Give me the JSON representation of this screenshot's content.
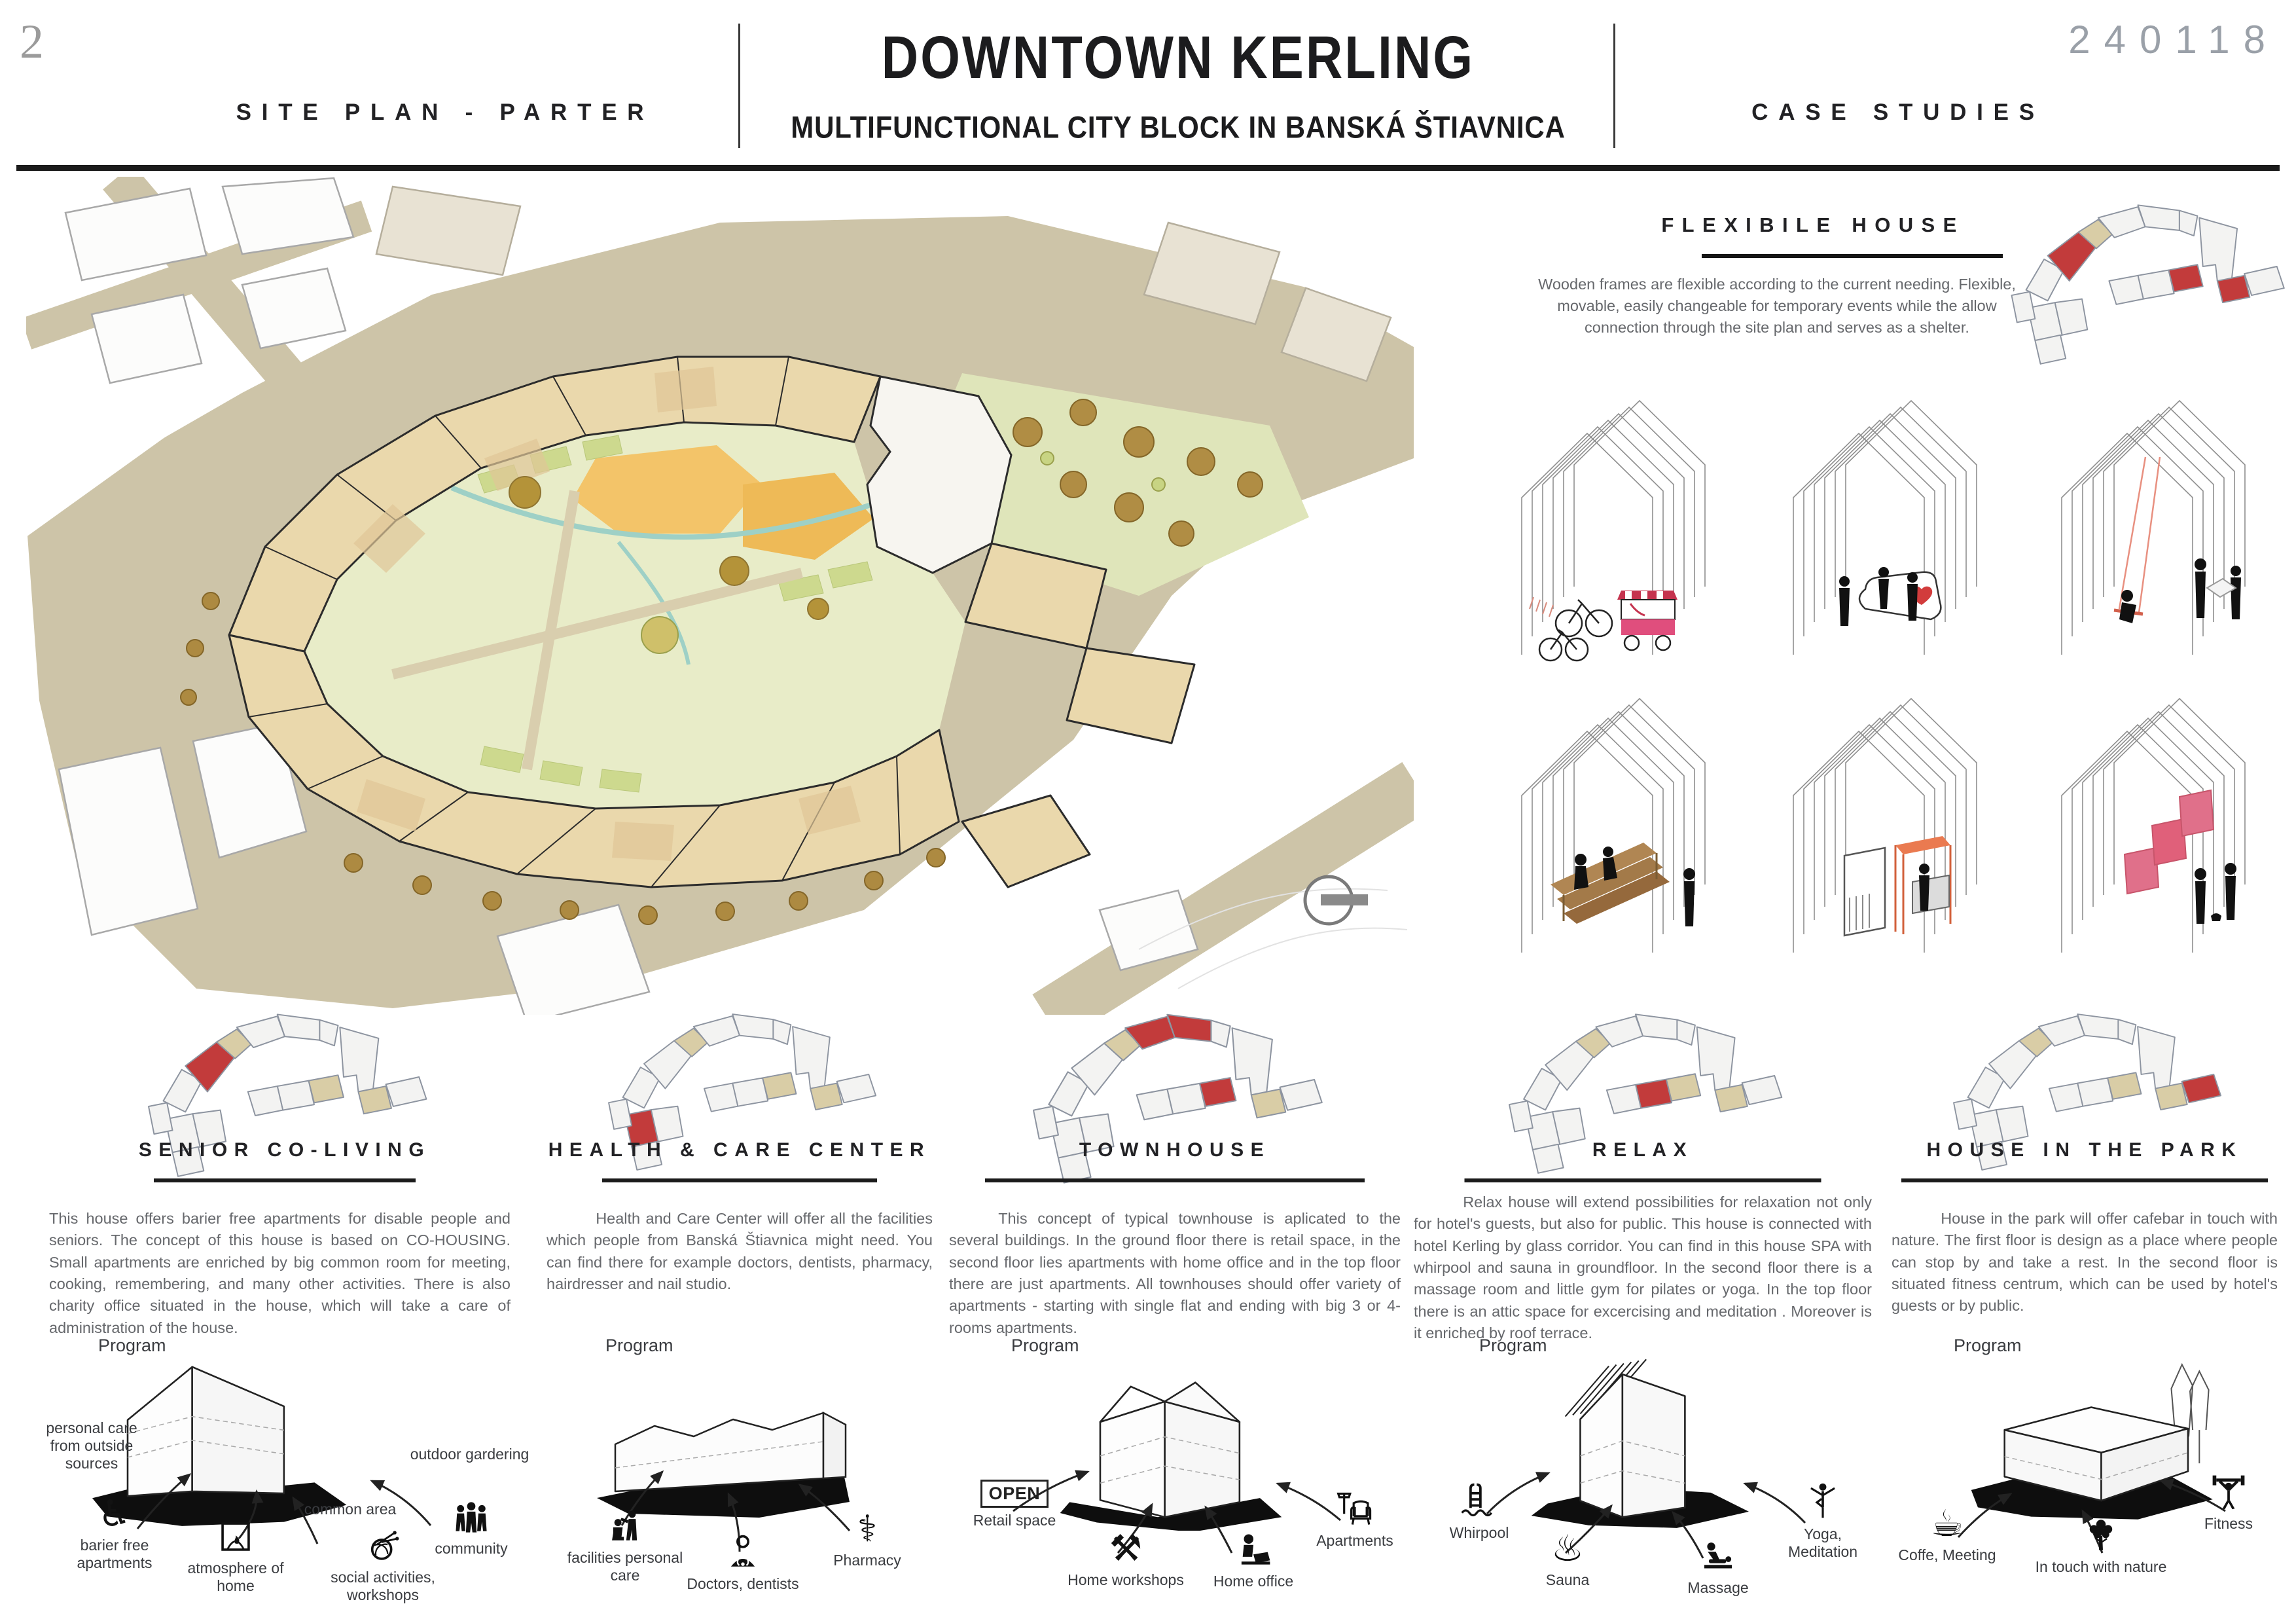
{
  "page": {
    "number": "2",
    "code": "240118"
  },
  "header": {
    "left_title": "SITE PLAN - PARTER",
    "title": "DOWNTOWN KERLING",
    "subtitle": "MULTIFUNCTIONAL CITY BLOCK IN BANSKÁ ŠTIAVNICA",
    "right_title": "CASE STUDIES"
  },
  "flexible_house": {
    "title": "FLEXIBILE HOUSE",
    "text": "Wooden frames are flexible according to the current needing. Flexible, movable, easily changeable for temporary events while the allow connection through the site plan and serves as a shelter.",
    "sketch_names": [
      "bike-parking and street-food cart",
      "info point",
      "swing",
      "wooden tribune",
      "café pavilion",
      "exhibition panels"
    ]
  },
  "labels": {
    "program": "Program"
  },
  "icons": {
    "wheelchair": "♿",
    "pharmacy": "⚕",
    "tools": "⚒",
    "sauna": "♨",
    "coffee": "☕",
    "open_sign": "OPEN"
  },
  "accent": {
    "red": "#c23b3b",
    "tan": "#d9cda6",
    "plan_beige": "#ead8ac",
    "court_green": "#e8ecc8"
  },
  "case_studies": [
    {
      "title": "SENIOR CO-LIVING",
      "text": "This house offers barier free apartments for disable people and seniors. The concept of this house is based on CO-HOUSING. Small apartments are enriched by big common room for meeting, cooking, remembering, and many other activities. There is also charity office situated in the house, which will take a care of administration of the house.",
      "items": [
        {
          "icon": "none",
          "label": "personal care from outside sources"
        },
        {
          "icon": "wheelchair",
          "label": "barier free apartments"
        },
        {
          "icon": "fireplace",
          "label": "atmosphere of home"
        },
        {
          "icon": "none",
          "label": "common area"
        },
        {
          "icon": "yarn",
          "label": "social activities, workshops"
        },
        {
          "icon": "community",
          "label": "community"
        },
        {
          "icon": "none",
          "label": "outdoor gardering"
        }
      ]
    },
    {
      "title": "HEALTH & CARE CENTER",
      "text": "Health and Care Center will offer all the facilities which people from Banská Štiavnica might need. You can find there for example doctors, dentists, pharmacy, hairdresser and nail studio.",
      "items": [
        {
          "icon": "hairdresser",
          "label": "facilities personal care"
        },
        {
          "icon": "doctor",
          "label": "Doctors, dentists"
        },
        {
          "icon": "pharmacy",
          "label": "Pharmacy"
        }
      ]
    },
    {
      "title": "TOWNHOUSE",
      "text": "This concept of typical townhouse is aplicated to the several buildings. In the ground floor there is retail space, in the second floor lies apartments with home office and in the top floor there are just apartments. All townhouses should offer variety of apartments - starting with single flat and ending with big 3 or 4-rooms apartments.",
      "items": [
        {
          "icon": "open-sign",
          "label": "Retail space"
        },
        {
          "icon": "tools",
          "label": "Home workshops"
        },
        {
          "icon": "home-office",
          "label": "Home office"
        },
        {
          "icon": "armchair",
          "label": "Apartments"
        }
      ]
    },
    {
      "title": "RELAX",
      "text": "Relax house will extend possibilities for relaxation not only for hotel's guests, but also for public. This house is connected with hotel Kerling by glass corridor. You can find in this house SPA with whirpool and sauna in groundfloor. In the second floor there is a massage room and little gym for pilates or yoga. In the top floor there is an attic space for excercising and meditation . Moreover is it enriched by roof terrace.",
      "items": [
        {
          "icon": "whirlpool",
          "label": "Whirpool"
        },
        {
          "icon": "sauna",
          "label": "Sauna"
        },
        {
          "icon": "massage",
          "label": "Massage"
        },
        {
          "icon": "yoga",
          "label": "Yoga, Meditation"
        }
      ]
    },
    {
      "title": "HOUSE IN THE PARK",
      "text": "House in the park will offer cafebar in touch with nature. The first floor is design as a place where people can stop by and take a rest. In the second floor is situated fitness centrum, which can be used by hotel's guests or by public.",
      "items": [
        {
          "icon": "coffee",
          "label": "Coffe, Meeting"
        },
        {
          "icon": "tree",
          "label": "In touch with nature"
        },
        {
          "icon": "fitness",
          "label": "Fitness"
        }
      ]
    }
  ]
}
